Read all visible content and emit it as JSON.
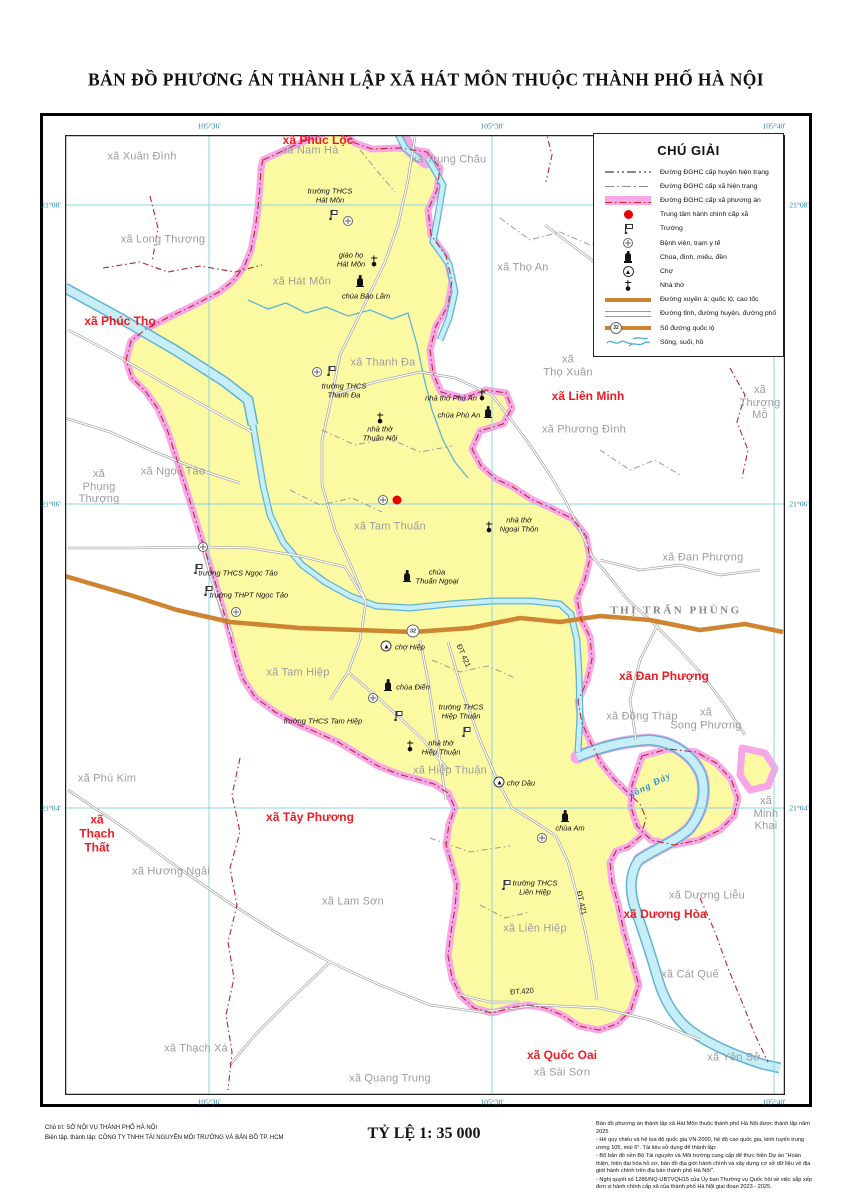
{
  "title": "BẢN ĐỒ PHƯƠNG ÁN THÀNH LẬP XÃ HÁT MÔN THUỘC THÀNH PHỐ HÀ NỘI",
  "coordinates": {
    "top": [
      "105°36'",
      "105°38'",
      "105°40'"
    ],
    "bottom": [
      "105°36'",
      "105°38'",
      "105°40'"
    ],
    "left": [
      "21°08'",
      "21°06'",
      "21°04'"
    ],
    "right": [
      "21°08'",
      "21°06'",
      "21°04'"
    ]
  },
  "legend": {
    "title": "CHÚ GIẢI",
    "items": [
      {
        "symbol": "district-boundary-current",
        "label": "Đường ĐGHC cấp huyện hiện trạng"
      },
      {
        "symbol": "commune-boundary-current",
        "label": "Đường ĐGHC cấp xã hiện trạng"
      },
      {
        "symbol": "commune-boundary-planned",
        "label": "Đường ĐGHC cấp xã phương án"
      },
      {
        "symbol": "commune-center",
        "label": "Trung tâm hành chính cấp xã"
      },
      {
        "symbol": "school",
        "label": "Trường"
      },
      {
        "symbol": "hospital",
        "label": "Bệnh viện, trạm y tế"
      },
      {
        "symbol": "pagoda",
        "label": "Chùa, đình, miếu, đền"
      },
      {
        "symbol": "market",
        "label": "Chợ"
      },
      {
        "symbol": "church",
        "label": "Nhà thờ"
      },
      {
        "symbol": "highway",
        "label": "Đường xuyên á; quốc lộ; cao tốc"
      },
      {
        "symbol": "road",
        "label": "Đường tỉnh, đường huyện, đường phố"
      },
      {
        "symbol": "route-number",
        "label": "Số đường quốc lộ"
      },
      {
        "symbol": "river",
        "label": "Sông, suối, hồ"
      }
    ]
  },
  "map": {
    "highlight_commune": "xã Hát Môn",
    "red_labels": [
      "xã Phúc Lộc",
      "xã Phúc Thọ",
      "xã Liên Minh",
      "xã Đan Phượng",
      "xã Tây Phương",
      "xã\nThạch\nThất",
      "xã Dương Hòa",
      "xã Quốc Oai"
    ],
    "gray_labels": [
      "xã Xuân Đình",
      "xã Nam Hà",
      "xã Trung Châu",
      "xã Long Thượng",
      "xã Thọ An",
      "xã Hát Môn",
      "xã Thanh Đa",
      "xã\nThọ Xuân",
      "xã Phương Đình",
      "xã\nThượng\nMỗ",
      "xã\nPhụng\nThượng",
      "xã Ngọc Tảo",
      "xã Tam Thuấn",
      "xã Đan Phượng",
      "xã Đồng Tháp",
      "xã\nSong Phương",
      "xã Tam Hiệp",
      "xã Hiệp Thuận",
      "xã Phú Kim",
      "xã\nMinh\nKhai",
      "xã Hương Ngải",
      "xã Lam Sơn",
      "xã Dương Liễu",
      "xã Liên Hiệp",
      "xã Cát Quế",
      "xã Thạch Xá",
      "xã Quang Trung",
      "xã Sài Sơn",
      "xã Yên Sở"
    ],
    "town_label": "THỊ TRẤN PHÙNG",
    "poi_labels": [
      "trường THCS\nHát Môn",
      "giáo họ\nHát Môn",
      "chùa Bảo Lâm",
      "trường THCS\nThanh Đa",
      "nhà thờ Phú An",
      "chùa Phù An",
      "nhà thờ\nThuấn Nội",
      "nhà thờ\nNgoại Thôn",
      "chùa\nThuấn Ngoại",
      "trường THCS Ngọc Tảo",
      "trường THPT Ngọc Tảo",
      "chợ Hiệp",
      "chùa Điến",
      "trường THCS Tam Hiệp",
      "trường THCS\nHiệp Thuận",
      "nhà thờ\nHiệp Thuận",
      "chợ Dâu",
      "chùa Am",
      "trường THCS\nLiên Hiệp"
    ],
    "road_labels": [
      "ĐT 421",
      "ĐT 421",
      "ĐT.420"
    ],
    "river_label": "sông Đáy",
    "route_number": "32"
  },
  "footer": {
    "left_line1": "Chủ trì: SỞ NỘI VỤ THÀNH PHỐ HÀ NỘI",
    "left_line2": "Biên tập, thành lập: CÔNG TY TNHH TÀI NGUYÊN MÔI TRƯỜNG VÀ BẢN ĐỒ TP. HCM",
    "scale": "TỶ LỆ 1: 35 000",
    "right_lines": [
      "Bản đồ phương án thành lập xã Hát Môn thuộc thành phố Hà Nội được thành lập năm 2025",
      "- Hệ quy chiếu và hệ tọa độ quốc gia VN-2000, hệ độ cao quốc gia, kinh tuyến trung ương 105, múi 6°. Tài liệu sử dụng để thành lập:",
      "- Bộ bản đồ nền Bộ Tài nguyên và Môi trường cung cấp để thực hiện Dự án \"Hoàn thiện, hiện đại hóa hồ sơ, bản đồ địa giới hành chính và xây dựng cơ sở dữ liệu về địa giới hành chính trên địa bàn thành phố Hà Nội\".",
      "- Nghị quyết số 1286/NQ-UBTVQH15 của Ủy ban Thường vụ Quốc hội về việc sắp xếp đơn vị hành chính cấp xã của thành phố Hà Nội giai đoạn 2023 - 2025."
    ]
  },
  "colors": {
    "commune_fill": "#FCF9A3",
    "planned_boundary_pink": "#F7A7E8",
    "district_boundary_red": "#C2272D",
    "highway_orange": "#CE8430",
    "water_fill": "#C7EEF6",
    "water_stroke": "#5FB4D4",
    "grid_blue": "#8ED3E6",
    "label_gray": "#9C9C9C",
    "label_red": "#EC1C24",
    "coordinate_teal": "#1D85AD",
    "center_dot_red": "#E80007"
  }
}
